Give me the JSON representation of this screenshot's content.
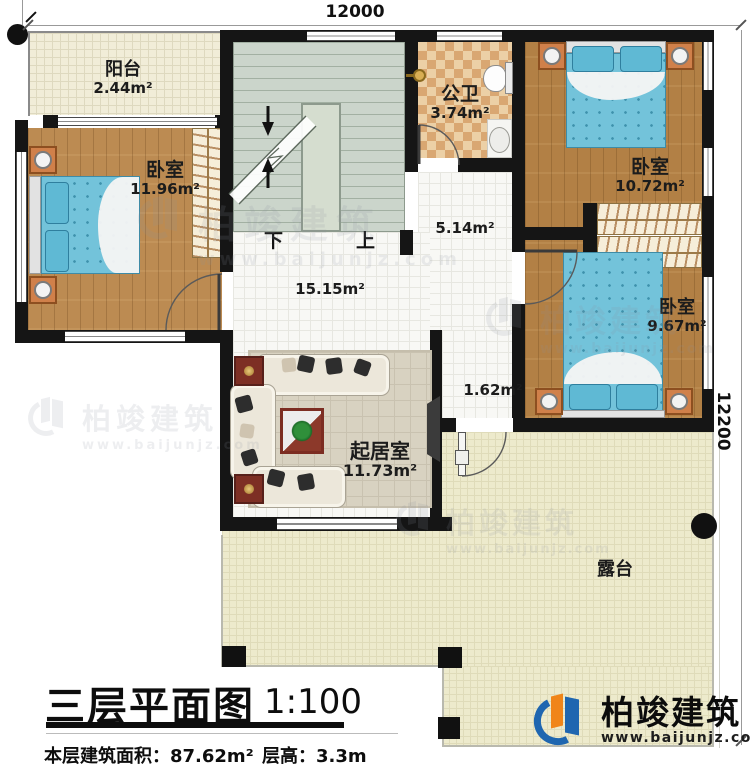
{
  "dimensions": {
    "top": "12000",
    "right": "12200"
  },
  "rooms": {
    "balcony": {
      "name": "阳台",
      "area": "2.44m²"
    },
    "bedroom_left": {
      "name": "卧室",
      "area": "11.96m²"
    },
    "bathroom": {
      "name": "公卫",
      "area": "3.74m²"
    },
    "bedroom_top_right": {
      "name": "卧室",
      "area": "10.72m²"
    },
    "bedroom_bottom_right": {
      "name": "卧室",
      "area": "9.67m²"
    },
    "living_room": {
      "name": "起居室",
      "area": "11.73m²"
    },
    "hall": {
      "area": "15.15m²"
    },
    "corridor": {
      "area": "5.14m²"
    },
    "entry": {
      "area": "1.62m²"
    },
    "terrace": {
      "name": "露台"
    }
  },
  "stairs": {
    "down": "下",
    "up": "上"
  },
  "title_block": {
    "title": "三层平面图",
    "scale": "1:100",
    "area_text": "本层建筑面积：87.62m²",
    "height_text": "层高：3.3m"
  },
  "branding": {
    "company": "柏竣建筑",
    "website": "www.baijunjz.com"
  },
  "colors": {
    "wall": "#151515",
    "wood": "#b28045",
    "mattress": "#73c3da",
    "terrace_floor": "#edeacc",
    "stairs_floor": "#cbd5cb",
    "brand_blue": "#1f66b0",
    "brand_orange": "#f08519"
  }
}
